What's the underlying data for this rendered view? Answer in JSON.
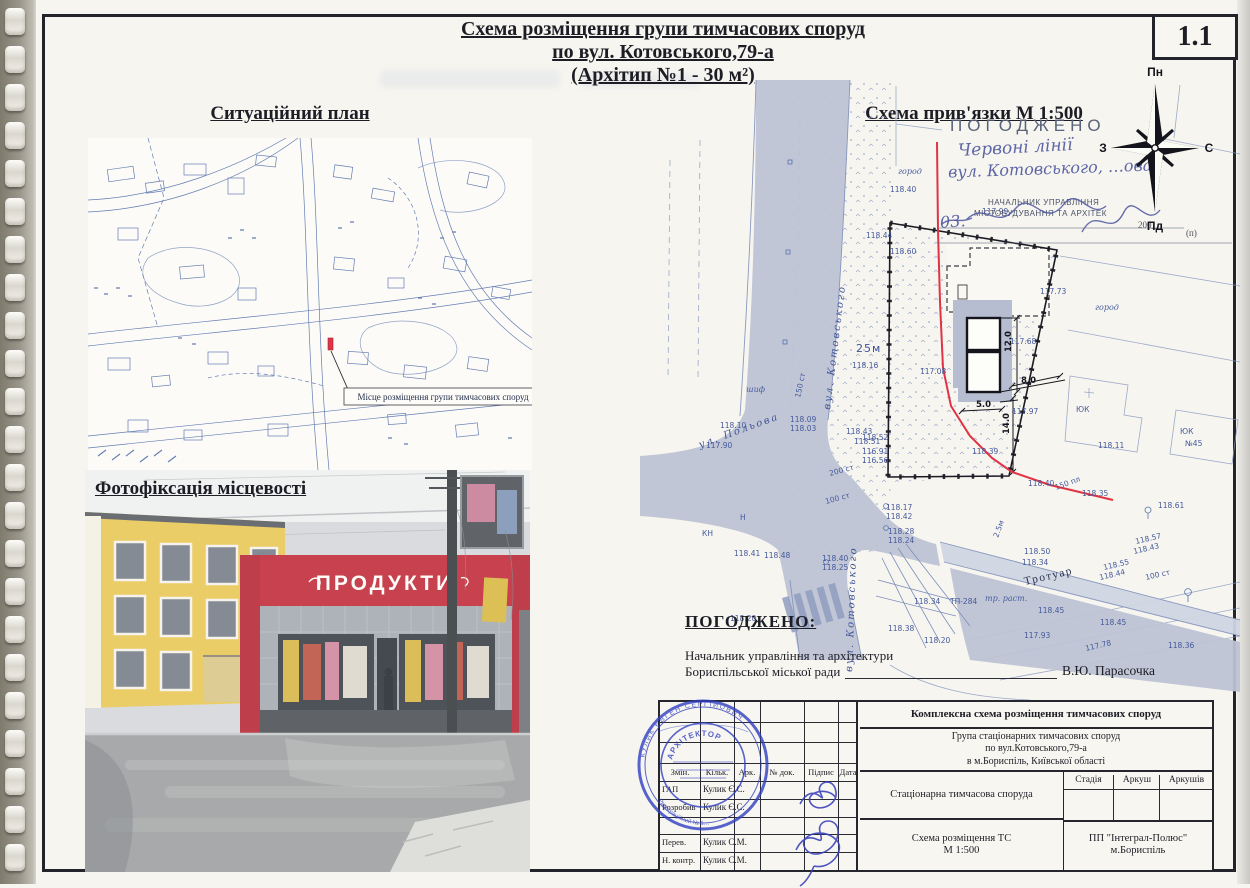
{
  "page": {
    "sheet_number": "1.1"
  },
  "title": {
    "line1": "Схема розміщення групи тимчасових споруд",
    "line2": "по вул. Котовського,79-а",
    "line3": "(Архітип №1 - 30 м²)"
  },
  "situational_plan": {
    "heading": "Ситуаційний план",
    "marker_label": "Місце розміщення групи тимчасових споруд"
  },
  "photo": {
    "heading": "Фотофіксація місцевості",
    "store_sign": "ПРОДУКТИ"
  },
  "site_plan": {
    "heading": "Схема прив'язки  М 1:500",
    "labels": [
      {
        "text": "вул. Котовського",
        "x": 190,
        "y": 330,
        "rot": -83,
        "cls": "street"
      },
      {
        "text": "вул. Котовського",
        "x": 212,
        "y": 592,
        "rot": -88,
        "cls": "street"
      },
      {
        "text": "ул. Польова",
        "x": 60,
        "y": 368,
        "rot": -20,
        "cls": "street"
      },
      {
        "text": "Тротуар",
        "x": 385,
        "y": 505,
        "rot": -13,
        "cls": "trot"
      },
      {
        "text": "город",
        "x": 258,
        "y": 94,
        "cls": "it"
      },
      {
        "text": "город",
        "x": 455,
        "y": 230,
        "cls": "it"
      },
      {
        "text": "шиф",
        "x": 106,
        "y": 312,
        "cls": "it"
      },
      {
        "text": "тр. раст.",
        "x": 345,
        "y": 521,
        "cls": "it"
      },
      {
        "text": "ТП-284",
        "x": 310,
        "y": 524
      },
      {
        "text": "КН",
        "x": 62,
        "y": 456
      },
      {
        "text": "Н",
        "x": 100,
        "y": 440
      },
      {
        "text": "ЮК",
        "x": 436,
        "y": 332
      },
      {
        "text": "ЮК",
        "x": 540,
        "y": 354
      },
      {
        "text": "№45",
        "x": 545,
        "y": 366
      },
      {
        "text": "25м",
        "x": 216,
        "y": 272,
        "cls": "big"
      },
      {
        "text": "118.40",
        "x": 250,
        "y": 112
      },
      {
        "text": "117.99",
        "x": 342,
        "y": 134
      },
      {
        "text": "118.44",
        "x": 226,
        "y": 158
      },
      {
        "text": "118.60",
        "x": 250,
        "y": 174
      },
      {
        "text": "117.73",
        "x": 400,
        "y": 214
      },
      {
        "text": "117.68",
        "x": 370,
        "y": 264
      },
      {
        "text": "118.16",
        "x": 212,
        "y": 288
      },
      {
        "text": "117.08",
        "x": 280,
        "y": 294
      },
      {
        "text": "118.43",
        "x": 206,
        "y": 354
      },
      {
        "text": "118.10",
        "x": 80,
        "y": 348
      },
      {
        "text": "117.90",
        "x": 66,
        "y": 368
      },
      {
        "text": "118.09",
        "x": 150,
        "y": 342
      },
      {
        "text": "118.03",
        "x": 150,
        "y": 351
      },
      {
        "text": "118.52",
        "x": 222,
        "y": 360
      },
      {
        "text": "118.51",
        "x": 214,
        "y": 364
      },
      {
        "text": "116.91",
        "x": 222,
        "y": 374
      },
      {
        "text": "116.56",
        "x": 222,
        "y": 383
      },
      {
        "text": "118.17",
        "x": 246,
        "y": 430
      },
      {
        "text": "118.42",
        "x": 246,
        "y": 439
      },
      {
        "text": "118.28",
        "x": 248,
        "y": 454
      },
      {
        "text": "118.24",
        "x": 248,
        "y": 463
      },
      {
        "text": "118.41",
        "x": 94,
        "y": 476
      },
      {
        "text": "118.48",
        "x": 124,
        "y": 478
      },
      {
        "text": "118.40",
        "x": 182,
        "y": 481
      },
      {
        "text": "118.25",
        "x": 182,
        "y": 490
      },
      {
        "text": "118.34",
        "x": 274,
        "y": 524
      },
      {
        "text": "118.38",
        "x": 248,
        "y": 551
      },
      {
        "text": "118.20",
        "x": 90,
        "y": 541
      },
      {
        "text": "118.20",
        "x": 284,
        "y": 563
      },
      {
        "text": "118.50",
        "x": 384,
        "y": 474
      },
      {
        "text": "118.34",
        "x": 382,
        "y": 485
      },
      {
        "text": "118.45",
        "x": 398,
        "y": 533
      },
      {
        "text": "118.45",
        "x": 460,
        "y": 545
      },
      {
        "text": "117.93",
        "x": 384,
        "y": 558
      },
      {
        "text": "118.36",
        "x": 528,
        "y": 568
      },
      {
        "text": "118.11",
        "x": 458,
        "y": 368
      },
      {
        "text": "118.35",
        "x": 442,
        "y": 416
      },
      {
        "text": "118.61",
        "x": 518,
        "y": 428
      },
      {
        "text": "118.39",
        "x": 332,
        "y": 374
      },
      {
        "text": "118.40",
        "x": 388,
        "y": 406
      },
      {
        "text": "117.97",
        "x": 372,
        "y": 334
      },
      {
        "text": "118.55",
        "x": 464,
        "y": 490,
        "rot": -13
      },
      {
        "text": "118.44",
        "x": 460,
        "y": 500,
        "rot": -13
      },
      {
        "text": "118.57",
        "x": 496,
        "y": 464,
        "rot": -13
      },
      {
        "text": "118.43",
        "x": 494,
        "y": 474,
        "rot": -13
      },
      {
        "text": "117.78",
        "x": 446,
        "y": 571,
        "rot": -13
      },
      {
        "text": "200 ст",
        "x": 190,
        "y": 396,
        "rot": -15
      },
      {
        "text": "100 ст",
        "x": 186,
        "y": 424,
        "rot": -15
      },
      {
        "text": "100 ст",
        "x": 506,
        "y": 500,
        "rot": -13
      },
      {
        "text": "150 пл",
        "x": 416,
        "y": 410,
        "rot": -20
      },
      {
        "text": "150 ст",
        "x": 160,
        "y": 318,
        "rot": -78
      },
      {
        "text": "2.5м",
        "x": 358,
        "y": 458,
        "rot": -70
      },
      {
        "text": "12.0",
        "x": 371,
        "y": 272,
        "rot": -90,
        "cls": "dim"
      },
      {
        "text": "8.0",
        "x": 381,
        "y": 303,
        "cls": "dim"
      },
      {
        "text": "5.0",
        "x": 336,
        "y": 327,
        "cls": "dim"
      },
      {
        "text": "14.0",
        "x": 369,
        "y": 354,
        "rot": -90,
        "cls": "dim"
      }
    ]
  },
  "stamp_top": {
    "title": "ПОГОДЖЕНО",
    "hand_line1": "Червоні лінії",
    "hand_line2": "вул. Котовського, …ова",
    "printed_line1": "НАЧАЛЬНИК УПРАВЛІННЯ",
    "printed_line2": "МІСТОБУДУВАННЯ ТА АРХІТЕК",
    "hand_date": "03.",
    "year_blank": "200__",
    "place_mark": "(п)"
  },
  "compass": {
    "north": "Пн",
    "south": "Пд",
    "west": "З",
    "east": "С"
  },
  "approval": {
    "heading": "ПОГОДЖЕНО:",
    "line1": "Начальник управління та архітектури",
    "line2": "Бориспільської міської ради",
    "signatory": "В.Ю. Парасочка"
  },
  "round_stamp": {
    "profession": "АРХІТЕКТОР",
    "name": "КУЛИК ЄВГЕН СЕРГІЙОВИЧ",
    "registry": "Реєстраційний № 1…"
  },
  "title_block": {
    "header_cols": [
      "Змін.",
      "Кільк.",
      "Арк.",
      "№ док.",
      "Підпис",
      "Дата"
    ],
    "rows": [
      {
        "role": "ГАП",
        "name": "Кулик Є.С."
      },
      {
        "role": "Розробив",
        "name": "Кулик Є.С."
      },
      {
        "role": "",
        "name": ""
      },
      {
        "role": "Перев.",
        "name": "Кулик С.М."
      },
      {
        "role": "Н. контр.",
        "name": "Кулик С.М."
      }
    ],
    "doc_title": "Комплексна схема розміщення тимчасових споруд",
    "object_line1": "Група стаціонарних тимчасових споруд",
    "object_line2": "по вул.Котовського,79-а",
    "object_line3": "в м.Бориспіль, Київської області",
    "stage_cols": [
      "Стадія",
      "Аркуш",
      "Аркушів"
    ],
    "type_label": "Стаціонарна тимчасова споруда",
    "sheet_name_line1": "Схема розміщення ТС",
    "sheet_name_line2": "М 1:500",
    "company_line1": "ПП \"Інтеграл-Полюс\"",
    "company_line2": "м.Бориспіль"
  },
  "colors": {
    "red_line": "#e03345",
    "road_fill": "#bdc3d4",
    "map_ink": "#5873ae",
    "stamp_blue": "#2f3fc1",
    "store_red": "#c02736",
    "building_yellow": "#e7c653"
  }
}
